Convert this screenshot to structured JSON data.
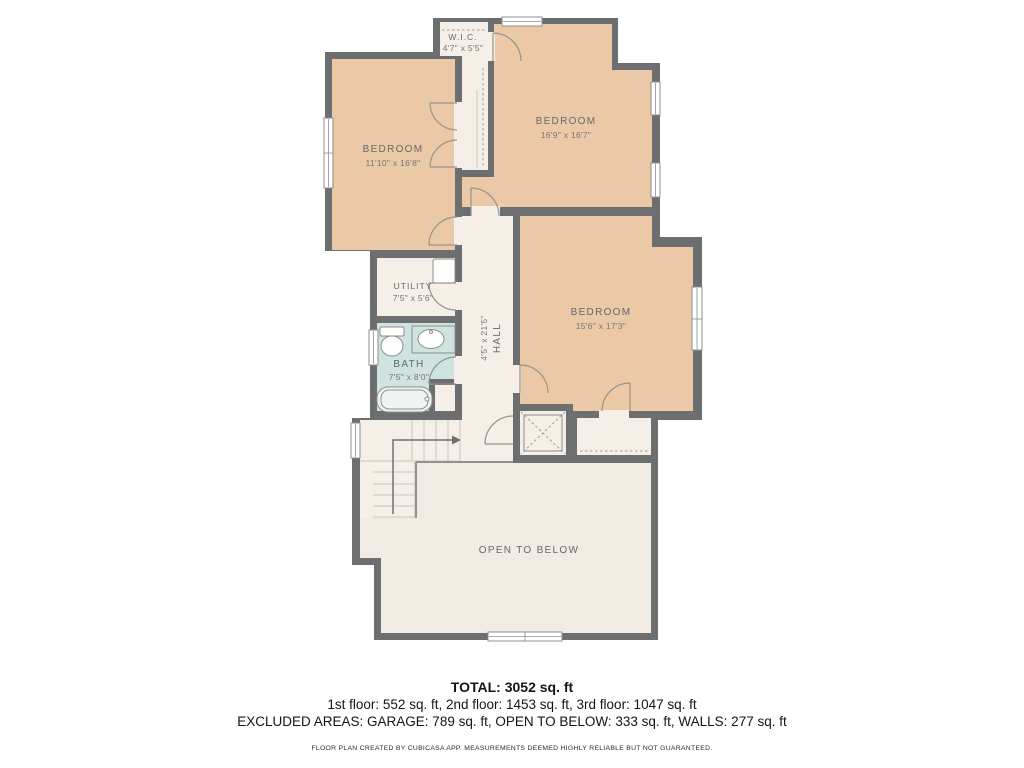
{
  "plan": {
    "rooms": {
      "wic": {
        "name": "W.I.C.",
        "dims": "4'7\" x 5'5\""
      },
      "bedroom_left": {
        "name": "BEDROOM",
        "dims": "11'10\" x 16'8\""
      },
      "bedroom_top": {
        "name": "BEDROOM",
        "dims": "16'9\" x 16'7\""
      },
      "bedroom_right": {
        "name": "BEDROOM",
        "dims": "15'6\" x 17'3\""
      },
      "utility": {
        "name": "UTILITY",
        "dims": "7'5\" x 5'6\""
      },
      "bath": {
        "name": "BATH",
        "dims": "7'5\" x 8'0\""
      },
      "hall": {
        "name": "HALL",
        "dims": "4'5\" x 21'5\""
      },
      "open_to_below": {
        "name": "OPEN TO BELOW"
      }
    },
    "colors": {
      "wall": "#6c6e70",
      "bedroom": "#ecc9a6",
      "floor": "#f6efe8",
      "floor_shaded": "#f2ebe4",
      "bath": "#cfe3e0",
      "background": "#ffffff"
    },
    "summary": {
      "total": "TOTAL: 3052 sq. ft",
      "floors": "1st floor: 552 sq. ft, 2nd floor: 1453 sq. ft, 3rd floor: 1047 sq. ft",
      "excluded": "EXCLUDED AREAS: GARAGE: 789 sq. ft, OPEN TO BELOW: 333 sq. ft, WALLS: 277 sq. ft",
      "disclaimer": "FLOOR PLAN CREATED BY CUBICASA APP. MEASUREMENTS DEEMED HIGHLY RELIABLE BUT NOT GUARANTEED."
    }
  }
}
